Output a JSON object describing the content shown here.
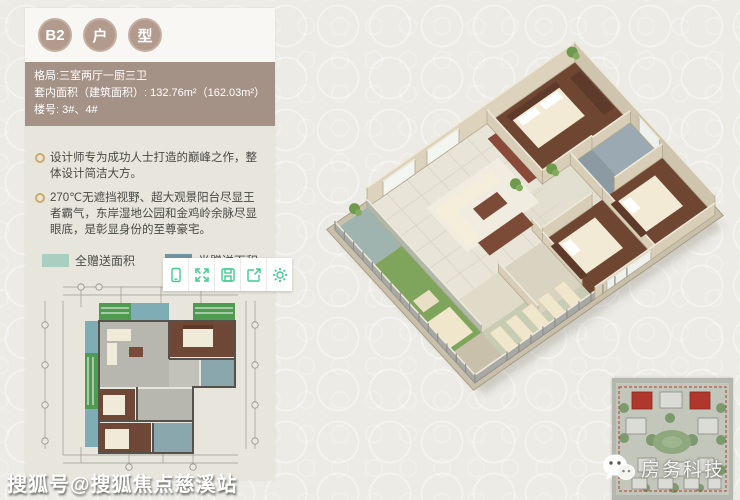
{
  "header": {
    "badges": [
      {
        "label": "B2"
      },
      {
        "label": "户"
      },
      {
        "label": "型"
      }
    ]
  },
  "info": {
    "lines": [
      "格局:三室两厅一厨三卫",
      "套内面积（建筑面积）: 132.76m²（162.03m²）",
      "楼号: 3#、4#"
    ],
    "bg_color": "#a59286"
  },
  "bullets": [
    "设计师专为成功人士打造的巅峰之作，整体设计简洁大方。",
    "270℃无遮挡视野、超大观景阳台尽显王者霸气，东岸湿地公园和金鸡岭余脉尽显眼底，是彰显身份的至尊豪宅。"
  ],
  "legend": {
    "items": [
      {
        "label": "全赠送面积",
        "color": "#a9cfc0"
      },
      {
        "label": "半赠送面积",
        "color": "#6f93a2"
      }
    ]
  },
  "toolbar": {
    "accent": "#3ecb8e",
    "buttons": [
      {
        "icon": "rotate-device-icon"
      },
      {
        "icon": "fullscreen-icon"
      },
      {
        "icon": "save-icon"
      },
      {
        "icon": "share-icon"
      },
      {
        "icon": "settings-icon"
      }
    ]
  },
  "watermarks": {
    "sohu": "搜狐号@搜狐焦点慈溪站",
    "wechat_brand": "房务科技"
  }
}
